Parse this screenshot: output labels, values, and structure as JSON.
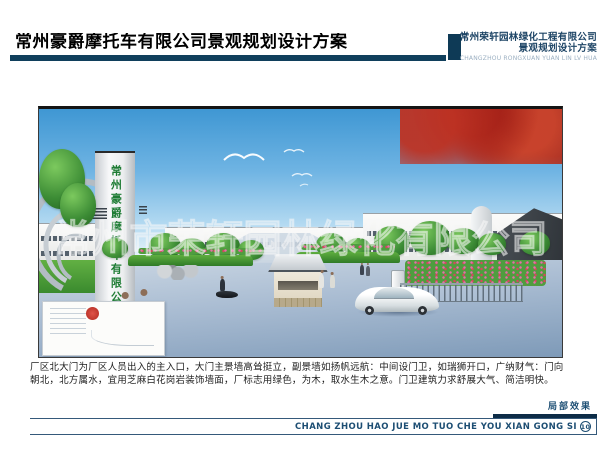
{
  "header": {
    "title": "常州豪爵摩托车有限公司景观规划设计方案",
    "firm_name": "常州荣轩园林绿化工程有限公司",
    "firm_subtitle": "景观规划设计方案",
    "firm_romanized": "CHANGZHOU RONGXUAN YUAN LIN LV HUA"
  },
  "rendering": {
    "tower_sign_text": "常州豪爵摩托车有限公司",
    "watermark_text": "常州市荣轩园林绿化有限公司"
  },
  "description": {
    "lines": [
      "厂区北大门为厂区人员出入的主入口，大门主景墙高耸挺立，副景墙如扬帆远航：中间设门卫，如瑞狮开口，广纳财气：门向",
      "朝北，北方属水，宜用芝麻白花岗岩装饰墙面，厂标志用绿色，为木，取水生木之意。门卫建筑力求舒展大气、简洁明快。"
    ]
  },
  "footer": {
    "caption": "局部效果",
    "romanized_title": "CHANG ZHOU HAO JUE MO TUO CHE YOU XIAN GONG SI",
    "page_number": "10"
  },
  "colors": {
    "accent_navy": "#0f3a56",
    "footer_navy": "#1d4e73",
    "sign_green": "#1e7c34",
    "sky_blue": "#54a6dc",
    "foliage_red": "#b5322a",
    "seal_red": "#c03026"
  }
}
